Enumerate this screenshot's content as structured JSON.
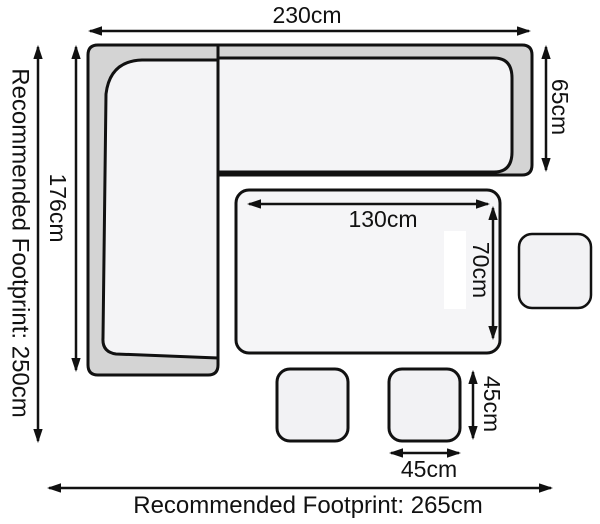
{
  "diagram": {
    "type": "furniture-footprint-dimensions",
    "labels": {
      "sofa_width": "230cm",
      "sofa_left_depth": "176cm",
      "sofa_right_depth": "65cm",
      "table_width": "130cm",
      "table_depth": "70cm",
      "stool_depth": "45cm",
      "stool_width": "45cm",
      "footprint_left": "Recommended Footprint: 250cm",
      "footprint_bottom": "Recommended Footprint: 265cm"
    },
    "colors": {
      "line": "#111111",
      "sofa_frame_fill": "#d4d4d4",
      "cushion_fill": "#f4f4f6",
      "table_fill": "#f5f5f7",
      "stool_fill": "#f2f2f4",
      "background": "#ffffff"
    }
  }
}
